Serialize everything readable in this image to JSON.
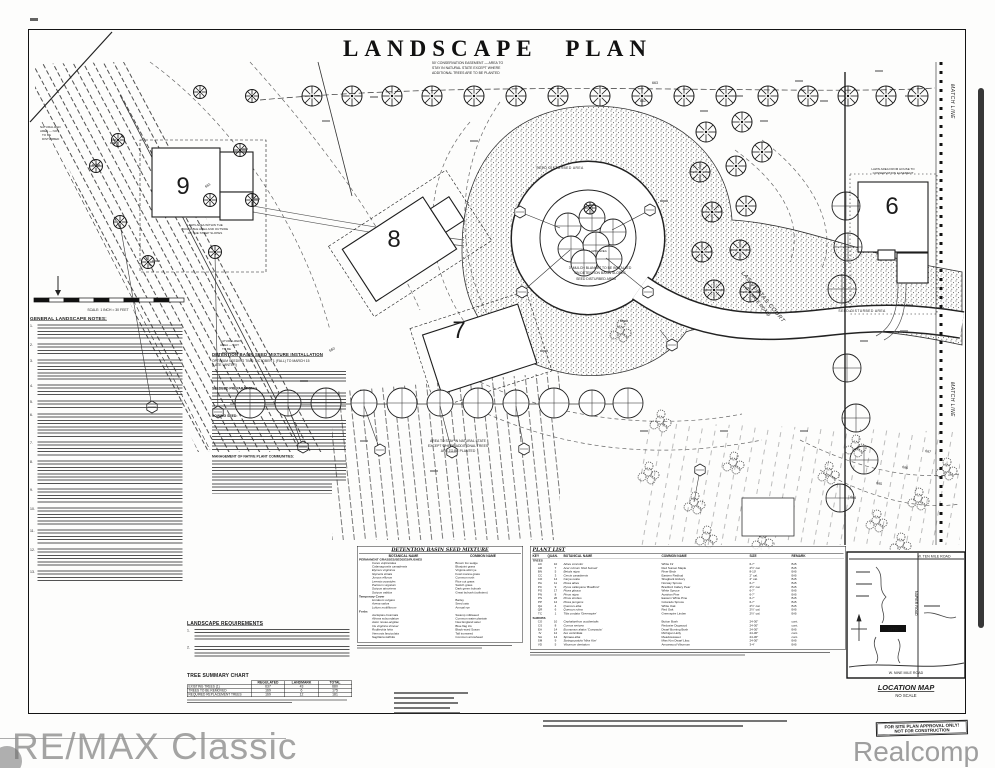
{
  "title": "LANDSCAPE PLAN",
  "watermarks": {
    "left": "RE/MAX Classic",
    "right": "Realcomp"
  },
  "stamp": {
    "line1": "FOR SITE PLAN APPROVAL ONLY!",
    "line2": "NOT FOR CONSTRUCTION"
  },
  "plan": {
    "lots": [
      "9",
      "8",
      "7",
      "6"
    ],
    "road_label_1": "LAS VENTAS COURT",
    "road_label_2": "(PRIVATE ROAD)",
    "match_line": "MATCH LINE",
    "scale_text": "SCALE: 1 INCH = 30 FEET",
    "contour_labels": [
      "660",
      "661",
      "662",
      "663",
      "664",
      "665",
      "666",
      "667"
    ],
    "notes": {
      "easement": [
        "50' CONSERVATION EASEMENT — AREA TO",
        "STAY IN NATURAL STATE EXCEPT WHERE",
        "ADDITIONAL TREES ARE TO BE PLANTED"
      ],
      "natural_state": [
        "AREA TO STAY IN NATURAL STATE",
        "EXCEPT WHERE ADDITIONAL TREES",
        "ARE TO BE PLANTED"
      ],
      "naturalized": [
        "NATURALIZED",
        "AREA — NOT",
        "TO BE",
        "DISTURBED"
      ],
      "mulch": [
        "3\" MULCH BLANKET TO BE INSTALLED",
        "ON DETENTION BASIN SLOPES"
      ],
      "seed_disturbed": "SEED DISTURBED AREA",
      "lawn_area": "LAWN AREA",
      "lot6_lawn": [
        "LAWN AREA FROM HOUSE TO",
        "CONSERVATION EASEMENT"
      ],
      "lot9_lawn": [
        "LAWN AREA WITHIN THE",
        "BUILDABLE AREA AND OUTSIDE",
        "OF THE STEEP SLOPES"
      ]
    }
  },
  "notes_column": {
    "heading": "GENERAL LANDSCAPE NOTES:",
    "numbers": [
      "1.",
      "2.",
      "3.",
      "4.",
      "5.",
      "6.",
      "7.",
      "8.",
      "9.",
      "10.",
      "11.",
      "12.",
      "13."
    ]
  },
  "basin_notes": {
    "heading": "DETENTION BASIN SEED MIXTURE INSTALLATION",
    "time1": "OPTIMUM SEEDING TIME:  OCTOBER 1 (FALL) TO MARCH 15",
    "time2": "(LATE WINTER)",
    "subheads": [
      "SEEDBED PREPARATION:",
      "SOWING SEED:",
      "MANAGEMENT OF NATIVE PLANT COMMUNITIES:"
    ]
  },
  "seed_table": {
    "title": "DETENTION BASIN SEED MIXTURE",
    "headers": [
      "BOTANICAL NAME",
      "COMMON NAME"
    ],
    "groups": [
      {
        "name": "PERMANENT GRASSES/SEDGES/RUSHES",
        "rows": [
          [
            "Carex vulpinoidea",
            "Brown fox sedge"
          ],
          [
            "Calamagrostis canadensis",
            "Bluejoint grass"
          ],
          [
            "Elymus virginicus",
            "Virginia wild rye"
          ],
          [
            "Glyceria striata",
            "Fowl manna grass"
          ],
          [
            "Juncus effusus",
            "Common rush"
          ],
          [
            "Leersia oryzoides",
            "Rice cut grass"
          ],
          [
            "Panicum virgatum",
            "Switch grass"
          ],
          [
            "Scirpus atrovirens",
            "Dark green bulrush"
          ],
          [
            "Scirpus validus",
            "Great bulrush (softstem)"
          ]
        ]
      },
      {
        "name": "Temporary Cover",
        "rows": [
          [
            "Hordeum vulgare",
            "Barley"
          ],
          [
            "Avena sativa",
            "Seed oats"
          ],
          [
            "Lolium multiflorum",
            "Annual rye"
          ]
        ]
      },
      {
        "name": "Forbs",
        "rows": [
          [
            "Asclepias incarnata",
            "Swamp milkweed"
          ],
          [
            "Alisma subcordatum",
            "Common water plantain"
          ],
          [
            "Aster novae-angliae",
            "New England aster"
          ],
          [
            "Iris virginica shrevei",
            "Blue flag iris"
          ],
          [
            "Rudbeckia hirta",
            "Black-eyed Susan"
          ],
          [
            "Vernonia fasciculata",
            "Tall ironweed"
          ],
          [
            "Sagittaria latifolia",
            "Common arrowhead"
          ]
        ]
      }
    ]
  },
  "plant_list": {
    "title": "PLANT LIST",
    "headers": [
      "KEY",
      "QUAN.",
      "BOTANICAL NAME",
      "COMMON NAME",
      "SIZE",
      "REMARK"
    ],
    "groups": [
      {
        "name": "TREES",
        "rows": [
          [
            "AC",
            "10",
            "Abies concolor",
            "White Fir",
            "6-7'",
            "B-B"
          ],
          [
            "AR",
            "7",
            "Acer rubrum 'Red Sunset'",
            "Red Sunset Maple",
            "2½\" cal.",
            "B-B"
          ],
          [
            "BN",
            "5",
            "Betula nigra",
            "River Birch",
            "8-10'",
            "B-B"
          ],
          [
            "CC",
            "3",
            "Cercis canadensis",
            "Eastern Redbud",
            "2\" cal.",
            "B-B"
          ],
          [
            "CO",
            "14",
            "Carya ovata",
            "Shagbark Hickory",
            "2\" cal.",
            "B-B"
          ],
          [
            "PA",
            "11",
            "Picea abies",
            "Norway Spruce",
            "6-7'",
            "B-B"
          ],
          [
            "PC",
            "9",
            "Pyrus calleryana 'Bradford'",
            "Bradford Callery Pear",
            "2½\" cal.",
            "B-B"
          ],
          [
            "PG",
            "17",
            "Picea glauca",
            "White Spruce",
            "6-7'",
            "B-B"
          ],
          [
            "PN",
            "8",
            "Pinus nigra",
            "Austrian Pine",
            "6-7'",
            "B-B"
          ],
          [
            "PS",
            "26",
            "Pinus strobus",
            "Eastern White Pine",
            "6-7'",
            "B-B"
          ],
          [
            "PP",
            "12",
            "Picea pungens",
            "Colorado Spruce",
            "6-7'",
            "B-B"
          ],
          [
            "QA",
            "4",
            "Quercus alba",
            "White Oak",
            "2½\" cal.",
            "B-B"
          ],
          [
            "QR",
            "6",
            "Quercus rubra",
            "Red Oak",
            "2½\" cal.",
            "B-B"
          ],
          [
            "TC",
            "1",
            "Tilia cordata 'Greenspire'",
            "Greenspire Linden",
            "2½\" cal.",
            "B-B"
          ]
        ]
      },
      {
        "name": "SHRUBS",
        "rows": [
          [
            "CO",
            "10",
            "Cephalanthus occidentalis",
            "Button Bush",
            "24-30\"",
            "cont."
          ],
          [
            "CS",
            "8",
            "Cornus sericea",
            "Redosier Dogwood",
            "24-30\"",
            "cont."
          ],
          [
            "EA",
            "14",
            "Euonymus alatus 'Compacta'",
            "Dwarf Burning Bush",
            "24-30\"",
            "B-B"
          ],
          [
            "IV",
            "12",
            "Ilex verticillata",
            "Michigan Holly",
            "24-30\"",
            "cont."
          ],
          [
            "SA",
            "14",
            "Spiraea alba",
            "Meadowsweet",
            "24-30\"",
            "cont."
          ],
          [
            "SM",
            "9",
            "Syringa patula 'Miss Kim'",
            "Miss Kim Dwarf Lilac",
            "24-30\"",
            "B-B"
          ],
          [
            "VD",
            "5",
            "Viburnum dentatum",
            "Arrowwood Viburnum",
            "3-4'",
            "B-B"
          ]
        ]
      }
    ]
  },
  "landscape_requirements": {
    "heading": "LANDSCAPE REQUIREMENTS",
    "numbers": [
      "1.",
      "2."
    ]
  },
  "tree_summary": {
    "heading": "TREE SUMMARY CHART",
    "columns": [
      "REGULATED",
      "LANDMARK",
      "TOTAL"
    ],
    "rows": [
      {
        "label": "EXISTING TREES (1)",
        "values": [
          "637",
          "43",
          "680"
        ]
      },
      {
        "label": "TREES TO BE REMOVED",
        "values": [
          "169",
          "6",
          "175"
        ]
      },
      {
        "label": "REQUIRED REPLACEMENT TREES",
        "values": [
          "169",
          "12",
          "181"
        ]
      }
    ]
  },
  "location_map": {
    "caption": "LOCATION MAP",
    "scale": "NO SCALE",
    "roads": {
      "top": "W. TEN MILE ROAD",
      "bottom": "W. NINE MILE ROAD",
      "vertical": "NAPIER ROAD"
    },
    "site": "SITE"
  }
}
